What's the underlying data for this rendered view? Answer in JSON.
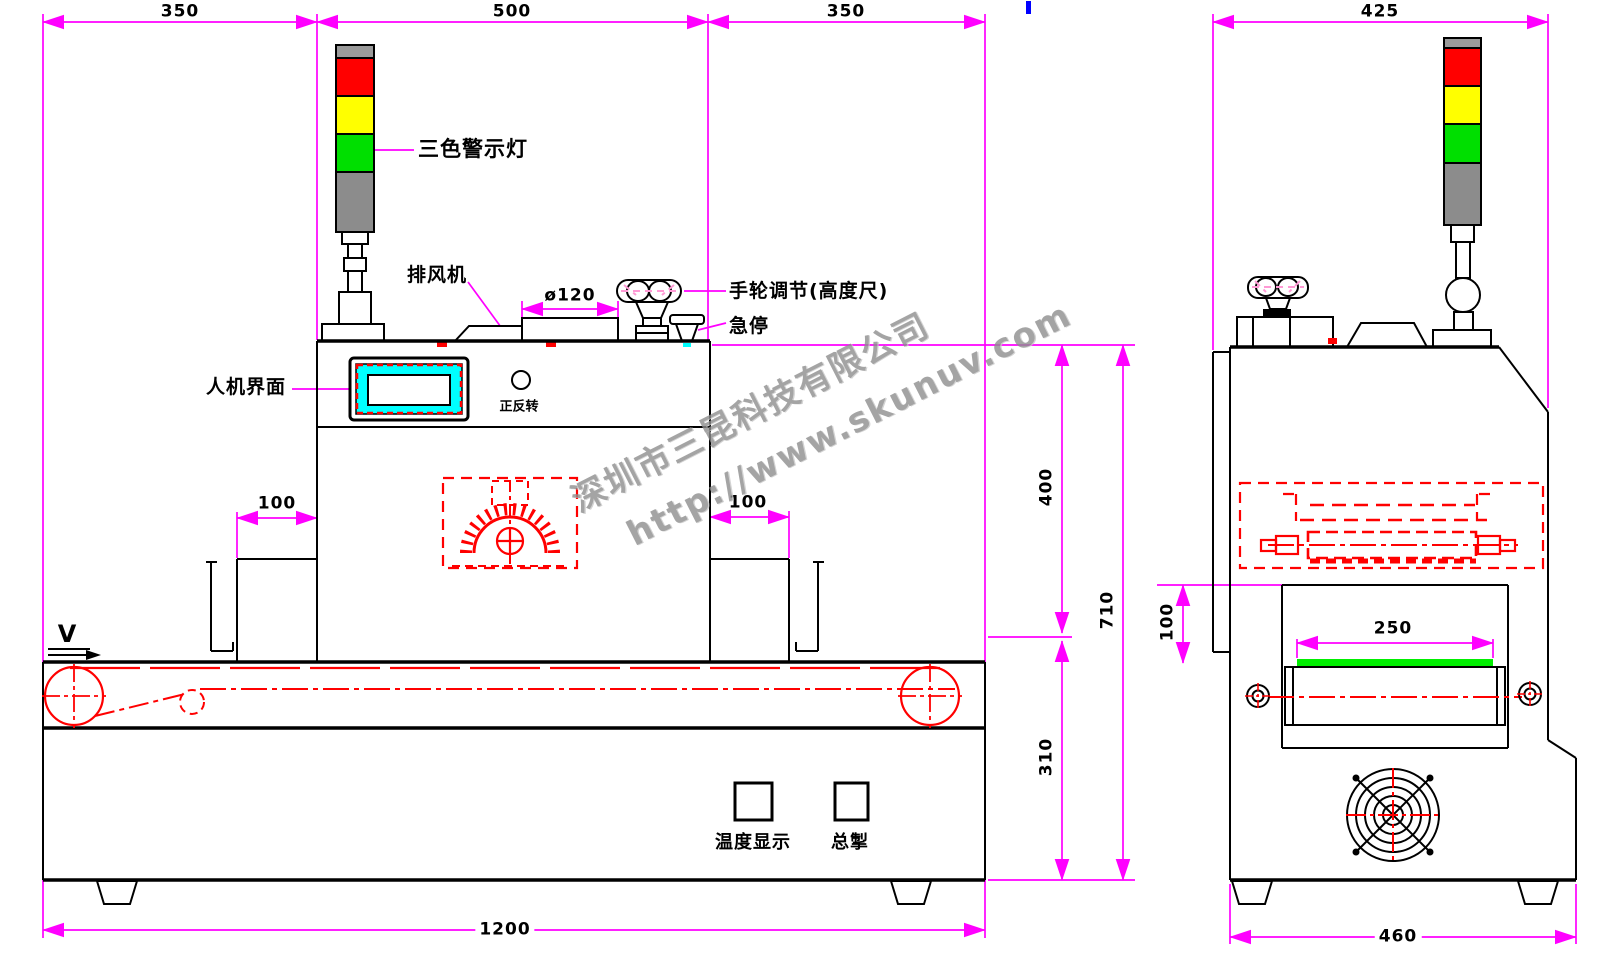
{
  "watermark": {
    "company": "深圳市三昆科技有限公司",
    "url": "http://www.skunuv.com"
  },
  "front_view": {
    "dim_top_left": "350",
    "dim_top_center": "500",
    "dim_top_right": "350",
    "dim_lamp_cover": "ø120",
    "dim_inlet_left": "100",
    "dim_outlet_right": "100",
    "dim_body_height": "400",
    "dim_base_height": "310",
    "dim_total_height": "710",
    "dim_total_length": "1200",
    "label_tower_light": "三色警示灯",
    "label_exhaust_fan": "排风机",
    "label_handwheel": "手轮调节(高度尺)",
    "label_emergency_stop": "急停",
    "label_hmi": "人机界面",
    "label_forward_reverse": "正反转",
    "label_temperature_display": "温度显示",
    "label_main_switch": "总掣",
    "label_belt_direction": "V"
  },
  "side_view": {
    "dim_top_width": "425",
    "dim_tunnel_height": "100",
    "dim_belt_width": "250",
    "dim_base_width": "460"
  },
  "colors": {
    "dimension_magenta": "#FF00FF",
    "drawing_red": "#FF0000",
    "lamp_red": "#FF0000",
    "lamp_yellow": "#FFFF00",
    "lamp_green": "#00DF00",
    "lamp_gray": "#8C8C8C",
    "belt_green": "#00EE00",
    "hmi_cyan": "#00FFFF",
    "accent_blue": "#0000FF"
  }
}
